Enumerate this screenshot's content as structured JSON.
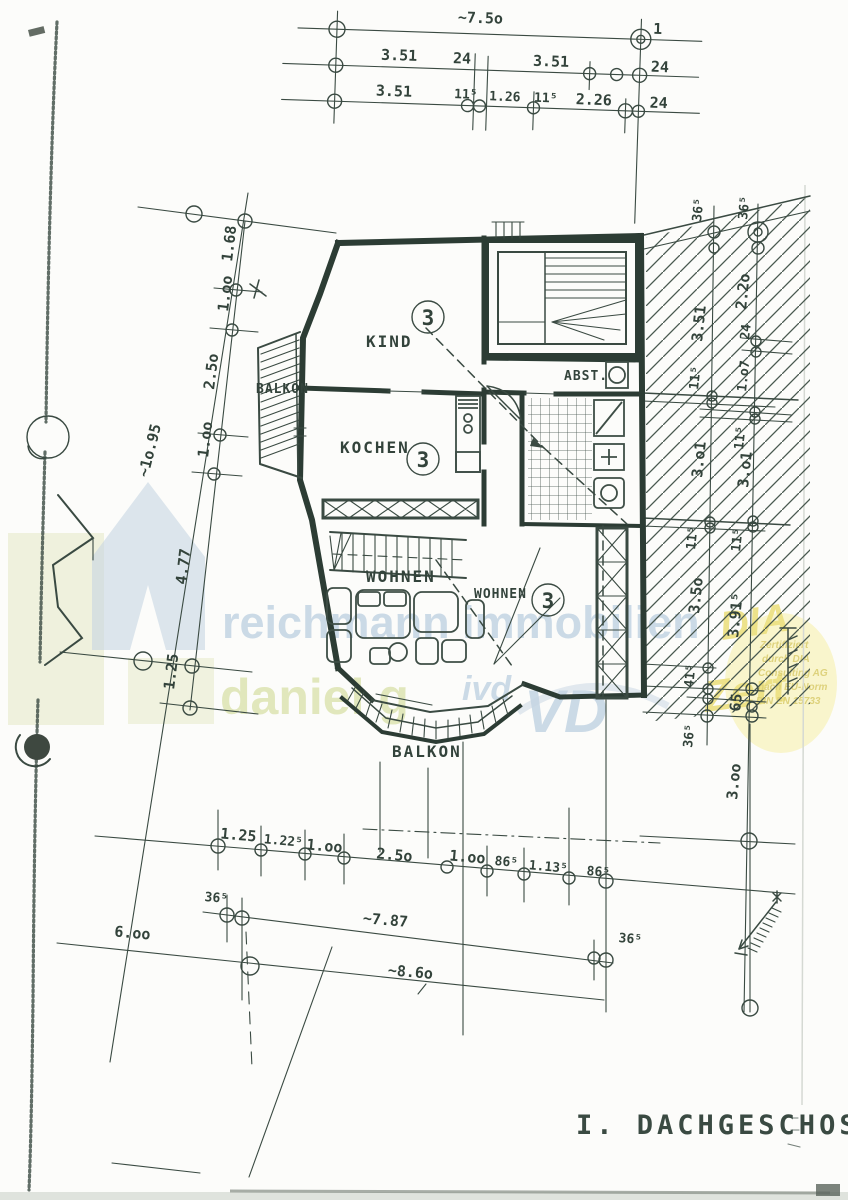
{
  "document": {
    "title": "I. DACHGESCHOSS"
  },
  "rooms": {
    "kind": "KIND",
    "kochen": "KOCHEN",
    "abst": "ABST.",
    "wohnen_a": "WOHNEN",
    "wohnen_b": "WOHNEN",
    "balkon_left": "BALKON",
    "balkon_bottom": "BALKON",
    "unit": "3"
  },
  "dims": {
    "top_row1": "~7.5o",
    "axis_mark": "1",
    "top_row2": [
      "3.51",
      "24",
      "3.51",
      "24"
    ],
    "top_row3": [
      "3.51",
      "11⁵",
      "1.26",
      "11⁵",
      "2.26",
      "24"
    ],
    "left_chain": [
      "1.68",
      "1.oo",
      "2.5o",
      "1.oo",
      "4.77",
      "1.25"
    ],
    "left_overall": "~1o.95",
    "right_inner": [
      "36⁵",
      "3.51",
      "11⁵",
      "3.o1",
      "11⁵",
      "3.5o",
      "41⁵",
      "36⁵"
    ],
    "right_outer": [
      "36⁵",
      "2.2o",
      "24",
      "1.o7",
      "11⁵",
      "3.o1",
      "11⁵",
      "3.91⁵",
      "65",
      "3.oo"
    ],
    "bottom_row1": [
      "1.25",
      "1.22⁵",
      "1.oo",
      "2.5o",
      "1.oo",
      "86⁵",
      "1.13⁵",
      "86⁵"
    ],
    "bottom_36_left": "36⁵",
    "bottom_787": "~7.87",
    "bottom_36_right": "36⁵",
    "bottom_600": "6.oo",
    "bottom_860": "~8.6o"
  },
  "watermarks": {
    "brand_line1": "reichmann immobilien",
    "brand_line2": "daniel g",
    "ivd_small": "ivd",
    "ivd_big": "VD",
    "dia_big_top": "DIA",
    "dia_big_bottom": "Zert",
    "dia_small": [
      "Zertifiziert",
      "durch DIA",
      "Consulting AG",
      "nach EU-Norm",
      "DIN EN 15733"
    ]
  }
}
